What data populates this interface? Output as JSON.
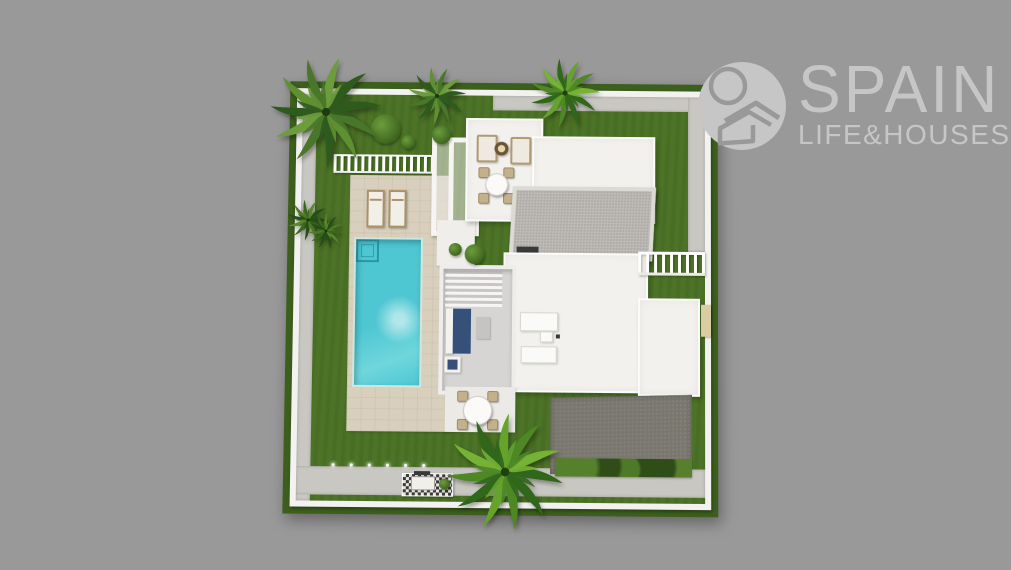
{
  "page": {
    "type": "aerial-3d-villa-render"
  },
  "logo": {
    "brand": "SPAIN",
    "tagline": "LIFE&HOUSES",
    "mark": "sun-and-house-circle-icon"
  },
  "colors": {
    "bg": "#9a999a",
    "logo": "#c7c6c6",
    "grass": "#4c7326",
    "grass_dark": "#3c5f1d",
    "deck": "#d8cfbd",
    "pool": "#4ec7d2",
    "roof_white": "#f2f1ed",
    "roof_gray": "#c1beb9",
    "driveway": "#7a776f",
    "wall": "#f3f2f0",
    "path": "#c9c7c2",
    "navy": "#35517a",
    "wood": "#ab9168",
    "gate": "#d9cda1"
  },
  "scene": {
    "features": [
      "perimeter-wall",
      "garden-lawn",
      "swimming-pool",
      "pool-steps",
      "sun-loungers",
      "pool-safety-fence",
      "pool-deck",
      "white-pergola",
      "roof-lounge-terrace",
      "fire-pit-table",
      "outdoor-armchairs",
      "round-dining-table",
      "flat-white-roof",
      "gravel-pitched-roof",
      "interior-courtyard",
      "navy-sofa",
      "kitchen-islands",
      "patio-dining-set",
      "gravel-driveway",
      "hedge-row",
      "bbq-counter",
      "garden-spotlights",
      "entrance-gate",
      "palm-trees",
      "shrubs"
    ]
  }
}
